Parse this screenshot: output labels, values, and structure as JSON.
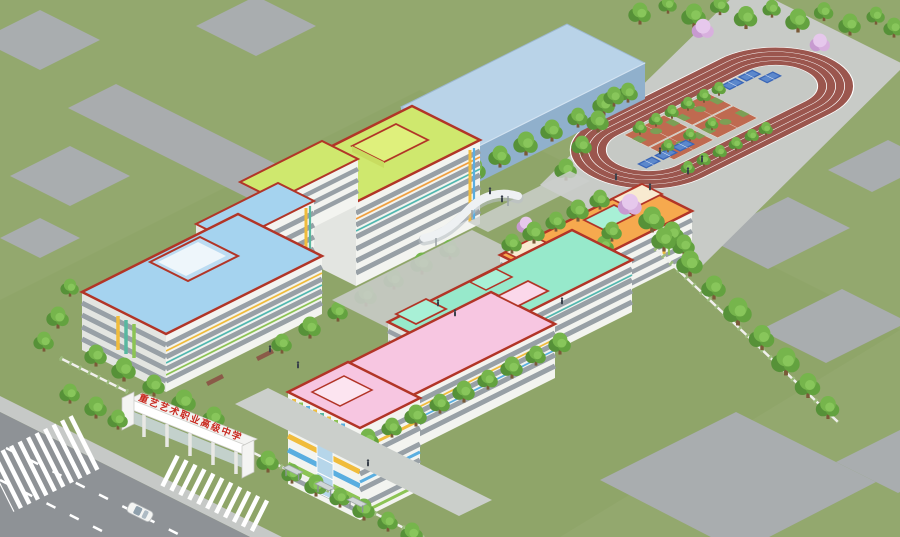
{
  "scene": {
    "description": "Aerial isometric 3D rendering of a vocational art high school campus",
    "view": "isometric aerial render"
  },
  "gate": {
    "sign_text": "重艺艺术职业高级中学",
    "sign_text_color": "#c8281e"
  },
  "sports": {
    "basketball_courts": 4,
    "blue_courts_top": 3,
    "blue_courts_bottom": 3,
    "running_track_shape": "oval"
  },
  "palette": {
    "grass": "#93a86e",
    "pad": "#a9adaf",
    "service_road": "#a9acae",
    "road": "#8e9296",
    "sidewalk": "#c6c9c7",
    "internal_road": "#cbcfcb",
    "plaza": "#c8cbc7",
    "track": "#9b564e",
    "infield": "#c6c9c5",
    "court_orange": "#bf6a50",
    "court_green": "#7c9f55",
    "court_blue": "#3a66b8",
    "court_blue_light": "#5c88cc",
    "gym_top": "#b9d3e8",
    "gym_sw": "#a6c2da",
    "gym_se": "#90b0cc",
    "roof_blue": "#a5d3ef",
    "roof_yellow_green": "#cfe86e",
    "roof_orange": "#f6a94e",
    "roof_mint": "#97e9cb",
    "roof_pink": "#f7c6e1",
    "roof_trim": "#b23527",
    "facade": "#f3f4f0",
    "facade_shade": "#e3e5e1",
    "window_band": "#98a0a6",
    "accent_yellow": "#f0bc3c",
    "accent_teal": "#52b8b0",
    "accent_green": "#8cc454",
    "accent_blue": "#5aaee0",
    "cream_box": "#f8ead0",
    "gate_red": "#c8281e"
  }
}
